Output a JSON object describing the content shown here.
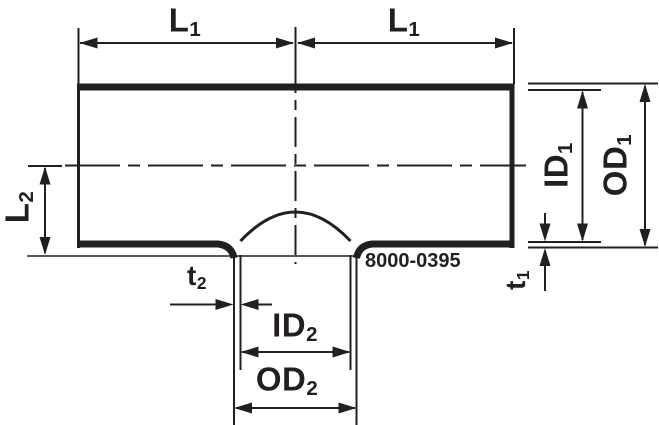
{
  "diagram": {
    "part_number": "8000-0395",
    "colors": {
      "line": "#231f20",
      "background": "#ffffff"
    },
    "dimension_labels": {
      "l1_left": {
        "base": "L",
        "sub": "1"
      },
      "l1_right": {
        "base": "L",
        "sub": "1"
      },
      "l2": {
        "base": "L",
        "sub": "2"
      },
      "id1": {
        "base": "ID",
        "sub": "1"
      },
      "od1": {
        "base": "OD",
        "sub": "1"
      },
      "t1": {
        "base": "t",
        "sub": "1"
      },
      "t2": {
        "base": "t",
        "sub": "2"
      },
      "id2": {
        "base": "ID",
        "sub": "2"
      },
      "od2": {
        "base": "OD",
        "sub": "2"
      }
    }
  }
}
